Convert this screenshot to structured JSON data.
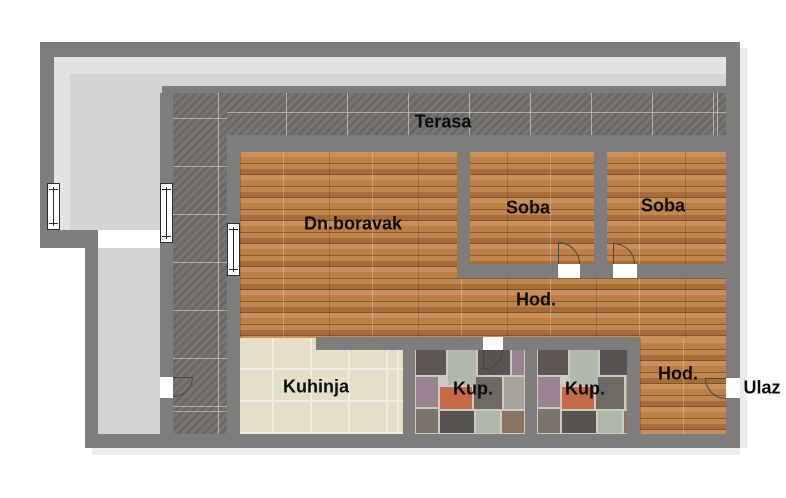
{
  "floor_plan": {
    "rooms": [
      {
        "id": "terasa",
        "label": "Terasa"
      },
      {
        "id": "dnevni-boravak",
        "label": "Dn.boravak"
      },
      {
        "id": "soba-1",
        "label": "Soba"
      },
      {
        "id": "soba-2",
        "label": "Soba"
      },
      {
        "id": "hodnik-1",
        "label": "Hod."
      },
      {
        "id": "kuhinja",
        "label": "Kuhinja"
      },
      {
        "id": "kupatilo-1",
        "label": "Kup."
      },
      {
        "id": "kupatilo-2",
        "label": "Kup."
      },
      {
        "id": "hodnik-2",
        "label": "Hod."
      },
      {
        "id": "ulaz",
        "label": "Ulaz"
      }
    ],
    "colors": {
      "wall": "#7f7d7b",
      "walkway": "#d4d4d4",
      "walkway_light": "#e2e2e2",
      "terrace_tile": "#716e6b",
      "wood": "#b1773f",
      "kitchen_tile": "#e6dfc7",
      "stone_grout": "#cfcabf",
      "label": "#0c0c0c",
      "background": "#ffffff"
    }
  }
}
